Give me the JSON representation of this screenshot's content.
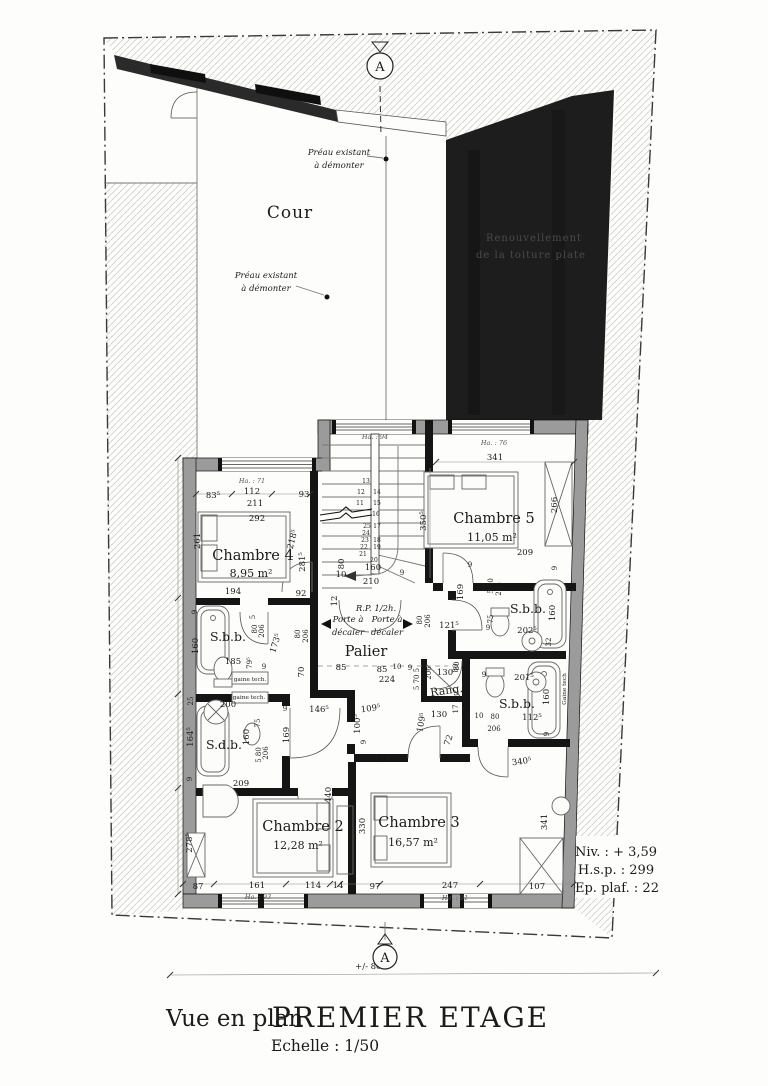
{
  "drawing": {
    "view_label": "Vue en plan",
    "title": "PREMIER ETAGE",
    "scale": "Echelle : 1/50",
    "section_marker": "A",
    "overall_dim": "+/- 860"
  },
  "notes": {
    "level": "Niv. : + 3,59",
    "ceiling_height": "H.s.p. : 299",
    "ceiling_thickness": "Ep. plaf. : 22"
  },
  "rooms": [
    {
      "name": "Chambre 2",
      "area": "12,28 m²"
    },
    {
      "name": "Chambre 3",
      "area": "16,57 m²"
    },
    {
      "name": "Chambre 4",
      "area": "8,95 m²"
    },
    {
      "name": "Chambre 5",
      "area": "11,05 m²"
    },
    {
      "name": "Palier"
    },
    {
      "name": "S.b.b."
    },
    {
      "name": "S.b.b."
    },
    {
      "name": "S.b.b."
    },
    {
      "name": "S.d.b."
    },
    {
      "name": "Rang."
    },
    {
      "name": "Cour"
    }
  ],
  "window_heights": [
    "Ha. : 71",
    "Ha. : 94",
    "Ha. : 76",
    "Ha. : 93",
    "Ha. : 91"
  ],
  "plan_texts": [
    {
      "t": "Cour",
      "x": 290,
      "y": 218,
      "c": "cour",
      "n": "courtyard-label"
    },
    {
      "t": "Préau existant",
      "x": 339,
      "y": 155,
      "c": "p",
      "n": "preau-note-1"
    },
    {
      "t": "à démonter",
      "x": 339,
      "y": 168,
      "c": "p",
      "n": "preau-note-1"
    },
    {
      "t": "Préau existant",
      "x": 266,
      "y": 278,
      "c": "p",
      "n": "preau-note-2"
    },
    {
      "t": "à démonter",
      "x": 266,
      "y": 291,
      "c": "p",
      "n": "preau-note-2"
    },
    {
      "t": "Renouvellement",
      "x": 534,
      "y": 241,
      "c": "roof",
      "n": "roof-note"
    },
    {
      "t": "de la toiture plate",
      "x": 531,
      "y": 258,
      "c": "roof",
      "n": "roof-note"
    },
    {
      "t": "Ha. : 71",
      "x": 252,
      "y": 483,
      "c": "h",
      "n": "window-height-label"
    },
    {
      "t": "Ha. : 94",
      "x": 375,
      "y": 439,
      "c": "h",
      "n": "window-height-label"
    },
    {
      "t": "Ha. : 76",
      "x": 494,
      "y": 445,
      "c": "h",
      "n": "window-height-label"
    },
    {
      "t": "Ha. : 93",
      "x": 258,
      "y": 899,
      "c": "h",
      "n": "window-height-label"
    },
    {
      "t": "Ha. : 91",
      "x": 455,
      "y": 900,
      "c": "h",
      "n": "window-height-label"
    },
    {
      "t": "83⁵",
      "x": 213,
      "y": 498
    },
    {
      "t": "112",
      "x": 252,
      "y": 494
    },
    {
      "t": "211",
      "x": 255,
      "y": 506
    },
    {
      "t": "93",
      "x": 304,
      "y": 497
    },
    {
      "t": "292",
      "x": 257,
      "y": 521
    },
    {
      "t": "261",
      "x": 200,
      "y": 541,
      "r": -90
    },
    {
      "t": "Chambre 4",
      "x": 253,
      "y": 560,
      "c": "r",
      "n": "room-label-chambre4"
    },
    {
      "t": "8,95 m²",
      "x": 251,
      "y": 577,
      "c": "a",
      "n": "room-area-chambre4"
    },
    {
      "t": "218⁵",
      "x": 295,
      "y": 540,
      "r": -75
    },
    {
      "t": "281⁵",
      "x": 305,
      "y": 562,
      "r": -90
    },
    {
      "t": "194",
      "x": 233,
      "y": 594
    },
    {
      "t": "92",
      "x": 301,
      "y": 596
    },
    {
      "t": "341",
      "x": 495,
      "y": 460
    },
    {
      "t": "Chambre 5",
      "x": 494,
      "y": 523,
      "c": "r",
      "n": "room-label-chambre5"
    },
    {
      "t": "11,05 m²",
      "x": 492,
      "y": 541,
      "c": "a",
      "n": "room-area-chambre5"
    },
    {
      "t": "350⁵",
      "x": 426,
      "y": 521,
      "r": -90
    },
    {
      "t": "266",
      "x": 557,
      "y": 505,
      "r": -90
    },
    {
      "t": "209",
      "x": 525,
      "y": 555
    },
    {
      "t": "9",
      "x": 557,
      "y": 568,
      "r": -90,
      "c": "s"
    },
    {
      "t": "9",
      "x": 470,
      "y": 567,
      "c": "s"
    },
    {
      "t": "80",
      "x": 344,
      "y": 564,
      "r": -90
    },
    {
      "t": "10",
      "x": 341,
      "y": 577
    },
    {
      "t": "160",
      "x": 373,
      "y": 570
    },
    {
      "t": "210",
      "x": 371,
      "y": 584
    },
    {
      "t": "9",
      "x": 402,
      "y": 575,
      "c": "s"
    },
    {
      "t": "12",
      "x": 337,
      "y": 601,
      "r": -90
    },
    {
      "t": "R.P. 1/2h.",
      "x": 376,
      "y": 611,
      "c": "p",
      "n": "fire-rating-note"
    },
    {
      "t": "13",
      "x": 366,
      "y": 483,
      "c": "t"
    },
    {
      "t": "12",
      "x": 361,
      "y": 494,
      "c": "t"
    },
    {
      "t": "14",
      "x": 377,
      "y": 494,
      "c": "t"
    },
    {
      "t": "11",
      "x": 360,
      "y": 505,
      "c": "t"
    },
    {
      "t": "15",
      "x": 377,
      "y": 505,
      "c": "t"
    },
    {
      "t": "16",
      "x": 376,
      "y": 516,
      "c": "t"
    },
    {
      "t": "25",
      "x": 367,
      "y": 528,
      "c": "t"
    },
    {
      "t": "17",
      "x": 377,
      "y": 528,
      "c": "t"
    },
    {
      "t": "24",
      "x": 366,
      "y": 535,
      "c": "t"
    },
    {
      "t": "23",
      "x": 365,
      "y": 542,
      "c": "t"
    },
    {
      "t": "18",
      "x": 377,
      "y": 542,
      "c": "t"
    },
    {
      "t": "22",
      "x": 364,
      "y": 549,
      "c": "t"
    },
    {
      "t": "19",
      "x": 377,
      "y": 549,
      "c": "t"
    },
    {
      "t": "21",
      "x": 363,
      "y": 556,
      "c": "t"
    },
    {
      "t": "20",
      "x": 374,
      "y": 562,
      "c": "t"
    },
    {
      "t": "Porte à",
      "x": 348,
      "y": 622,
      "c": "p",
      "n": "door-shift-note"
    },
    {
      "t": "décaler",
      "x": 348,
      "y": 635,
      "c": "p",
      "n": "door-shift-note"
    },
    {
      "t": "Porte à",
      "x": 387,
      "y": 622,
      "c": "p",
      "n": "door-shift-note"
    },
    {
      "t": "décaler",
      "x": 387,
      "y": 635,
      "c": "p",
      "n": "door-shift-note"
    },
    {
      "t": "Palier",
      "x": 366,
      "y": 656,
      "c": "r",
      "n": "room-label-palier"
    },
    {
      "t": "85",
      "x": 341,
      "y": 670
    },
    {
      "t": "85",
      "x": 382,
      "y": 672
    },
    {
      "t": "224",
      "x": 387,
      "y": 682
    },
    {
      "t": "10",
      "x": 397,
      "y": 669,
      "c": "s"
    },
    {
      "t": "9",
      "x": 410,
      "y": 670,
      "c": "s"
    },
    {
      "t": "5 70 5",
      "x": 419,
      "y": 679,
      "r": -90,
      "c": "s"
    },
    {
      "t": "206",
      "x": 431,
      "y": 673,
      "r": -90,
      "c": "s"
    },
    {
      "t": "130",
      "x": 445,
      "y": 675
    },
    {
      "t": "80",
      "x": 458,
      "y": 668,
      "r": -90,
      "c": "s"
    },
    {
      "t": "Rang.",
      "x": 447,
      "y": 694,
      "c": "a",
      "r": -8,
      "n": "room-label-rang"
    },
    {
      "t": "121⁵",
      "x": 449,
      "y": 628
    },
    {
      "t": "80",
      "x": 422,
      "y": 620,
      "r": -90,
      "c": "s"
    },
    {
      "t": "206",
      "x": 430,
      "y": 621,
      "r": -90,
      "c": "s"
    },
    {
      "t": "9",
      "x": 197,
      "y": 612,
      "r": -90,
      "c": "s"
    },
    {
      "t": "160",
      "x": 198,
      "y": 646,
      "r": -90
    },
    {
      "t": "S.b.b.",
      "x": 228,
      "y": 641,
      "c": "r2",
      "n": "room-label-sbb-left"
    },
    {
      "t": "185",
      "x": 233,
      "y": 664
    },
    {
      "t": "5",
      "x": 255,
      "y": 617,
      "r": -90,
      "c": "s"
    },
    {
      "t": "80",
      "x": 257,
      "y": 629,
      "r": -90,
      "c": "s"
    },
    {
      "t": "206",
      "x": 264,
      "y": 631,
      "r": -90,
      "c": "s"
    },
    {
      "t": "79⁵",
      "x": 252,
      "y": 663,
      "r": -90,
      "c": "s"
    },
    {
      "t": "9",
      "x": 264,
      "y": 669,
      "c": "s"
    },
    {
      "t": "gaine tech.",
      "x": 250,
      "y": 681,
      "c": "g",
      "n": "duct-label"
    },
    {
      "t": "173⁵",
      "x": 278,
      "y": 644,
      "r": -72
    },
    {
      "t": "80",
      "x": 300,
      "y": 634,
      "r": -90,
      "c": "s"
    },
    {
      "t": "206",
      "x": 308,
      "y": 636,
      "r": -90,
      "c": "s"
    },
    {
      "t": "70",
      "x": 304,
      "y": 672,
      "r": -90
    },
    {
      "t": "25",
      "x": 193,
      "y": 701,
      "r": -90,
      "c": "s"
    },
    {
      "t": "200",
      "x": 228,
      "y": 707
    },
    {
      "t": "gaine tech.",
      "x": 249,
      "y": 699,
      "c": "g",
      "n": "duct-label"
    },
    {
      "t": "9",
      "x": 285,
      "y": 711,
      "c": "s"
    },
    {
      "t": "146⁵",
      "x": 319,
      "y": 712
    },
    {
      "t": "164⁵",
      "x": 193,
      "y": 737,
      "r": -90
    },
    {
      "t": "S.d.b.",
      "x": 224,
      "y": 749,
      "c": "r2",
      "n": "room-label-sdb"
    },
    {
      "t": "160",
      "x": 249,
      "y": 737,
      "r": -90
    },
    {
      "t": "75",
      "x": 260,
      "y": 723,
      "r": -90,
      "c": "s"
    },
    {
      "t": "5 80",
      "x": 261,
      "y": 755,
      "r": -90,
      "c": "s"
    },
    {
      "t": "206",
      "x": 268,
      "y": 753,
      "r": -90,
      "c": "s"
    },
    {
      "t": "169",
      "x": 289,
      "y": 735,
      "r": -90
    },
    {
      "t": "9",
      "x": 192,
      "y": 779,
      "r": -90,
      "c": "s"
    },
    {
      "t": "209",
      "x": 241,
      "y": 786
    },
    {
      "t": "440",
      "x": 331,
      "y": 795,
      "r": -90
    },
    {
      "t": "5 80",
      "x": 493,
      "y": 586,
      "r": -90,
      "c": "s"
    },
    {
      "t": "206",
      "x": 501,
      "y": 589,
      "r": -90,
      "c": "s"
    },
    {
      "t": "169",
      "x": 463,
      "y": 592,
      "r": -90
    },
    {
      "t": "S.b.b.",
      "x": 528,
      "y": 613,
      "c": "r2",
      "n": "room-label-sbb-right-top"
    },
    {
      "t": "160",
      "x": 555,
      "y": 613,
      "r": -90
    },
    {
      "t": "75",
      "x": 493,
      "y": 619,
      "r": -90,
      "c": "s"
    },
    {
      "t": "9",
      "x": 488,
      "y": 630,
      "c": "s"
    },
    {
      "t": "202⁵",
      "x": 527,
      "y": 633
    },
    {
      "t": "32",
      "x": 551,
      "y": 642,
      "r": -90,
      "c": "s"
    },
    {
      "t": "80",
      "x": 459,
      "y": 666,
      "r": -90,
      "c": "s"
    },
    {
      "t": "9",
      "x": 484,
      "y": 677,
      "c": "s"
    },
    {
      "t": "201⁵",
      "x": 524,
      "y": 680
    },
    {
      "t": "160",
      "x": 549,
      "y": 697,
      "r": -90
    },
    {
      "t": "Gaine tech",
      "x": 566,
      "y": 689,
      "r": -90,
      "c": "g",
      "n": "duct-label"
    },
    {
      "t": "S.b.b.",
      "x": 517,
      "y": 708,
      "c": "r2",
      "n": "room-label-sbb-right-bottom"
    },
    {
      "t": "17",
      "x": 458,
      "y": 709,
      "r": -90,
      "c": "s"
    },
    {
      "t": "130",
      "x": 439,
      "y": 717
    },
    {
      "t": "9",
      "x": 467,
      "y": 718,
      "c": "s"
    },
    {
      "t": "10",
      "x": 479,
      "y": 718,
      "c": "s"
    },
    {
      "t": "80",
      "x": 495,
      "y": 719,
      "c": "s"
    },
    {
      "t": "206",
      "x": 494,
      "y": 731,
      "c": "s"
    },
    {
      "t": "112⁵",
      "x": 532,
      "y": 720
    },
    {
      "t": "9",
      "x": 549,
      "y": 734,
      "r": -90,
      "c": "s"
    },
    {
      "t": "72",
      "x": 451,
      "y": 741,
      "r": -70
    },
    {
      "t": "340⁵",
      "x": 522,
      "y": 764,
      "r": -8
    },
    {
      "t": "109⁵",
      "x": 371,
      "y": 711,
      "r": -8
    },
    {
      "t": "100⁵",
      "x": 360,
      "y": 724,
      "r": -90
    },
    {
      "t": "9",
      "x": 366,
      "y": 742,
      "r": -90,
      "c": "s"
    },
    {
      "t": "109⁵",
      "x": 424,
      "y": 723,
      "r": -80
    },
    {
      "t": "114⁵",
      "x": 384,
      "y": 761
    },
    {
      "t": "Chambre 2",
      "x": 303,
      "y": 831,
      "c": "r",
      "n": "room-label-chambre2"
    },
    {
      "t": "12,28 m²",
      "x": 298,
      "y": 849,
      "c": "a",
      "n": "room-area-chambre2"
    },
    {
      "t": "278⁵",
      "x": 192,
      "y": 843,
      "r": -90
    },
    {
      "t": "330",
      "x": 365,
      "y": 826,
      "r": -90
    },
    {
      "t": "341",
      "x": 547,
      "y": 822,
      "r": -90
    },
    {
      "t": "Chambre 3",
      "x": 419,
      "y": 827,
      "c": "r",
      "n": "room-label-chambre3"
    },
    {
      "t": "16,57 m²",
      "x": 413,
      "y": 846,
      "c": "a",
      "n": "room-area-chambre3"
    },
    {
      "t": "87",
      "x": 198,
      "y": 889
    },
    {
      "t": "161",
      "x": 257,
      "y": 888
    },
    {
      "t": "114",
      "x": 313,
      "y": 888
    },
    {
      "t": "14",
      "x": 338,
      "y": 888
    },
    {
      "t": "97",
      "x": 375,
      "y": 889
    },
    {
      "t": "247",
      "x": 450,
      "y": 888
    },
    {
      "t": "107",
      "x": 537,
      "y": 889
    }
  ]
}
